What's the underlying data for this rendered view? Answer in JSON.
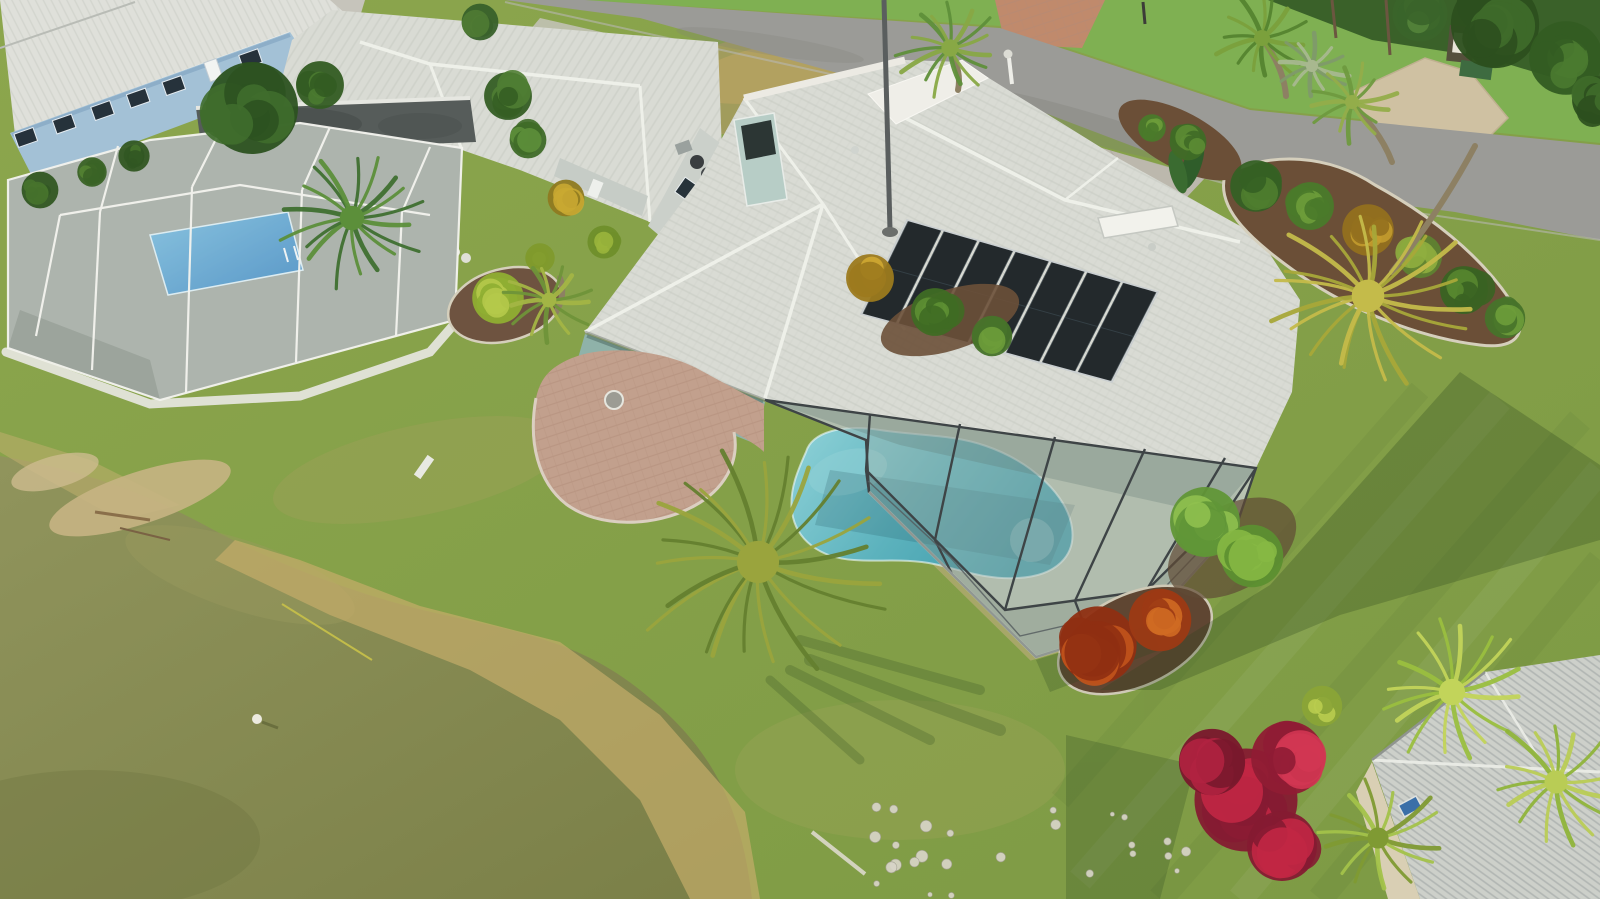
{
  "meta": {
    "type": "aerial-drone-photograph",
    "description": "Aerial view of a Florida waterfront home with white tile roof, rooftop solar panels, screened lanai with kidney-shaped pool, paver patio, palm trees, landscaped beds, neighboring houses, a street at top and a pond at bottom left",
    "width": 1600,
    "height": 899
  },
  "scene": {
    "colors": {
      "grassBase": "#87a24b",
      "grassFar": "#7fb052",
      "road": "#9b9b97",
      "concreteApron": "#c6c4bb",
      "drivewayMain": "#bcb8ad",
      "paverDrivewayAcross": "#c08a6c",
      "gravelPath": "#cfc1a2",
      "roofWhite": "#d9dbd4",
      "roofRidge": "#eef0e9",
      "roofBlueHouse": "#dfe0da",
      "roofNeighborBR": "#cdd0ca",
      "flatRoof": "#565c5a",
      "wallBlue": "#a3c1d6",
      "wallGray": "#cbd0ca",
      "wallTeal": "#8fb2a9",
      "wallBeige": "#d9cfb4",
      "chimneyTeal": "#b7cdc6",
      "solar": "#23292c",
      "poolMainLight": "#8fd2d8",
      "poolMainDeep": "#3f9cab",
      "poolNeighborLight": "#6db7dc",
      "poolNeighborDeep": "#2f7fbe",
      "deck": "#b9c3b1",
      "deckNeighbor": "#9ca59d",
      "screenTint": "#9fb0a4",
      "frameDark": "#3e4446",
      "frameWhite": "#f4f4ef",
      "paver": "#c2a08d",
      "mulch": "#6b4f37",
      "sand": "#c6b483",
      "dryGrass": "#c4ad6a",
      "water": "#8a8d52",
      "croton": "#c2541c",
      "bougainvillea": "#c12744",
      "hedge": "#86b844",
      "shadow": "#2a461e"
    },
    "solar": {
      "panels": 7,
      "corners": [
        [
          907,
          220
        ],
        [
          1158,
          292
        ],
        [
          1112,
          382
        ],
        [
          861,
          314
        ]
      ]
    },
    "palms": [
      {
        "name": "canary-island-date-palm",
        "cx": 758,
        "cy": 562,
        "r": 132,
        "fronds": 22,
        "c1": "#647f2f",
        "c2": "#9aa43d",
        "trunk": null
      },
      {
        "name": "patio-palm",
        "cx": 549,
        "cy": 300,
        "r": 46,
        "fronds": 14,
        "c1": "#6f9439",
        "c2": "#a3b545",
        "trunk": [
          556,
          312,
          560,
          278
        ]
      },
      {
        "name": "left-palm-cluster",
        "cx": 352,
        "cy": 218,
        "r": 76,
        "fronds": 18,
        "c1": "#3f7030",
        "c2": "#5c8f3a",
        "trunk": null
      },
      {
        "name": "roadside-palm",
        "cx": 950,
        "cy": 48,
        "r": 54,
        "fronds": 15,
        "c1": "#5f8f3a",
        "c2": "#88a845",
        "trunk": [
          958,
          90,
          950,
          52
        ]
      },
      {
        "name": "royal-palm",
        "cx": 1262,
        "cy": 38,
        "r": 50,
        "fronds": 14,
        "c1": "#55842f",
        "c2": "#7ba03c",
        "trunk": [
          1286,
          96,
          1266,
          44
        ]
      },
      {
        "name": "golden-palm",
        "cx": 1368,
        "cy": 296,
        "r": 102,
        "fronds": 20,
        "c1": "#a8a839",
        "c2": "#c4bb4a",
        "trunk": [
          1475,
          146,
          1392,
          272
        ]
      },
      {
        "name": "silver-fan-palm",
        "cx": 1312,
        "cy": 66,
        "r": 38,
        "fronds": 12,
        "c1": "#7f9a6a",
        "c2": "#a8b88f",
        "trunk": null
      },
      {
        "name": "queen-palm",
        "cx": 1352,
        "cy": 102,
        "r": 44,
        "fronds": 13,
        "c1": "#6f9a3f",
        "c2": "#93ad4a",
        "trunk": [
          1392,
          162,
          1356,
          108
        ]
      },
      {
        "name": "fan-palm-1",
        "cx": 1452,
        "cy": 692,
        "r": 82,
        "fronds": 16,
        "c1": "#9abf3f",
        "c2": "#c2d45a",
        "trunk": null
      },
      {
        "name": "fan-palm-2",
        "cx": 1556,
        "cy": 782,
        "r": 72,
        "fronds": 15,
        "c1": "#8fb43a",
        "c2": "#b9cc55",
        "trunk": null
      },
      {
        "name": "fan-palm-3",
        "cx": 1378,
        "cy": 838,
        "r": 66,
        "fronds": 14,
        "c1": "#a3c24a",
        "c2": "#7f9a33",
        "trunk": null
      }
    ],
    "bushes": [
      {
        "x": 870,
        "y": 278,
        "r": 26,
        "c1": "#cfa832",
        "c2": "#9c7a1e",
        "n": 7
      },
      {
        "x": 935,
        "y": 312,
        "r": 26,
        "c1": "#5d8f33",
        "c2": "#3f6b24",
        "n": 7
      },
      {
        "x": 992,
        "y": 336,
        "r": 22,
        "c1": "#6d9c3a",
        "c2": "#47732a",
        "n": 6
      },
      {
        "x": 498,
        "y": 298,
        "r": 28,
        "c1": "#b5c94a",
        "c2": "#8fae32",
        "n": 8
      },
      {
        "x": 540,
        "y": 258,
        "r": 16,
        "c1": "#a8bf3f",
        "c2": "#7f9a2c",
        "n": 5
      },
      {
        "x": 566,
        "y": 198,
        "r": 20,
        "c1": "#c9a832",
        "c2": "#8f7a20",
        "n": 6
      },
      {
        "x": 604,
        "y": 242,
        "r": 18,
        "c1": "#9ab53c",
        "c2": "#6f8f2a",
        "n": 6
      },
      {
        "x": 252,
        "y": 108,
        "r": 50,
        "c1": "#3f6d2c",
        "c2": "#2c5220",
        "n": 10
      },
      {
        "x": 320,
        "y": 85,
        "r": 26,
        "c1": "#4a7a30",
        "c2": "#335c22",
        "n": 7
      },
      {
        "x": 508,
        "y": 96,
        "r": 26,
        "c1": "#4f7d33",
        "c2": "#355e24",
        "n": 7
      },
      {
        "x": 528,
        "y": 140,
        "r": 20,
        "c1": "#5d8f3a",
        "c2": "#3f6b28",
        "n": 6
      },
      {
        "x": 480,
        "y": 22,
        "r": 20,
        "c1": "#4f7a33",
        "c2": "#38612a",
        "n": 6
      },
      {
        "x": 1495,
        "y": 24,
        "r": 48,
        "c1": "#3f6b2a",
        "c2": "#2c4f1e",
        "n": 9
      },
      {
        "x": 1566,
        "y": 58,
        "r": 40,
        "c1": "#4a7a30",
        "c2": "#335c22",
        "n": 8
      },
      {
        "x": 1420,
        "y": 14,
        "r": 30,
        "c1": "#54833a",
        "c2": "#3a642a",
        "n": 7
      },
      {
        "x": 1596,
        "y": 100,
        "r": 26,
        "c1": "#3f6b2a",
        "c2": "#2c4f1e",
        "n": 6
      },
      {
        "x": 1256,
        "y": 186,
        "r": 28,
        "c1": "#4f7d2f",
        "c2": "#356024",
        "n": 7
      },
      {
        "x": 1310,
        "y": 206,
        "r": 26,
        "c1": "#6d9c3a",
        "c2": "#4a7a2a",
        "n": 7
      },
      {
        "x": 1368,
        "y": 230,
        "r": 28,
        "c1": "#c39b2e",
        "c2": "#94701e",
        "n": 7
      },
      {
        "x": 1420,
        "y": 256,
        "r": 24,
        "c1": "#8fae3f",
        "c2": "#5f8230",
        "n": 6
      },
      {
        "x": 1464,
        "y": 290,
        "r": 26,
        "c1": "#57862f",
        "c2": "#3a6322",
        "n": 7
      },
      {
        "x": 1505,
        "y": 318,
        "r": 22,
        "c1": "#6d9c3a",
        "c2": "#47732a",
        "n": 6
      },
      {
        "x": 1188,
        "y": 142,
        "r": 20,
        "c1": "#5c8c34",
        "c2": "#3f6b26",
        "n": 6
      },
      {
        "x": 1152,
        "y": 128,
        "r": 15,
        "c1": "#6d9c3a",
        "c2": "#4a7a2a",
        "n": 5
      },
      {
        "x": 1205,
        "y": 522,
        "r": 38,
        "c1": "#8fc04f",
        "c2": "#619637",
        "n": 8
      },
      {
        "x": 1252,
        "y": 556,
        "r": 34,
        "c1": "#86b844",
        "c2": "#5c8f30",
        "n": 8
      },
      {
        "x": 1098,
        "y": 645,
        "r": 42,
        "c1": "#c2541c",
        "c2": "#8f2f12",
        "n": 9
      },
      {
        "x": 1160,
        "y": 620,
        "r": 34,
        "c1": "#cf6a22",
        "c2": "#9c3a14",
        "n": 8
      },
      {
        "x": 1246,
        "y": 800,
        "r": 56,
        "c1": "#c12744",
        "c2": "#851b32",
        "n": 10
      },
      {
        "x": 1288,
        "y": 758,
        "r": 40,
        "c1": "#d23652",
        "c2": "#8f1c34",
        "n": 8
      },
      {
        "x": 1212,
        "y": 762,
        "r": 36,
        "c1": "#b02240",
        "c2": "#79182c",
        "n": 8
      },
      {
        "x": 1282,
        "y": 846,
        "r": 38,
        "c1": "#c12744",
        "c2": "#851b32",
        "n": 8
      },
      {
        "x": 1322,
        "y": 706,
        "r": 22,
        "c1": "#b9cc4f",
        "c2": "#8aa437",
        "n": 6
      },
      {
        "x": 40,
        "y": 190,
        "r": 20,
        "c1": "#47732c",
        "c2": "#315722",
        "n": 6
      },
      {
        "x": 92,
        "y": 172,
        "r": 16,
        "c1": "#538232",
        "c2": "#3a6326",
        "n": 5
      },
      {
        "x": 134,
        "y": 156,
        "r": 17,
        "c1": "#47732c",
        "c2": "#315722",
        "n": 5
      }
    ],
    "rocks": {
      "x": 1030,
      "y": 852,
      "w": 330,
      "h": 90,
      "count": 26
    },
    "blueHouseWindows": {
      "a": [
        14,
        130
      ],
      "b": [
        288,
        34
      ],
      "ts": [
        0.06,
        0.2,
        0.34,
        0.47,
        0.6,
        0.88
      ],
      "doorT": 0.74
    }
  }
}
